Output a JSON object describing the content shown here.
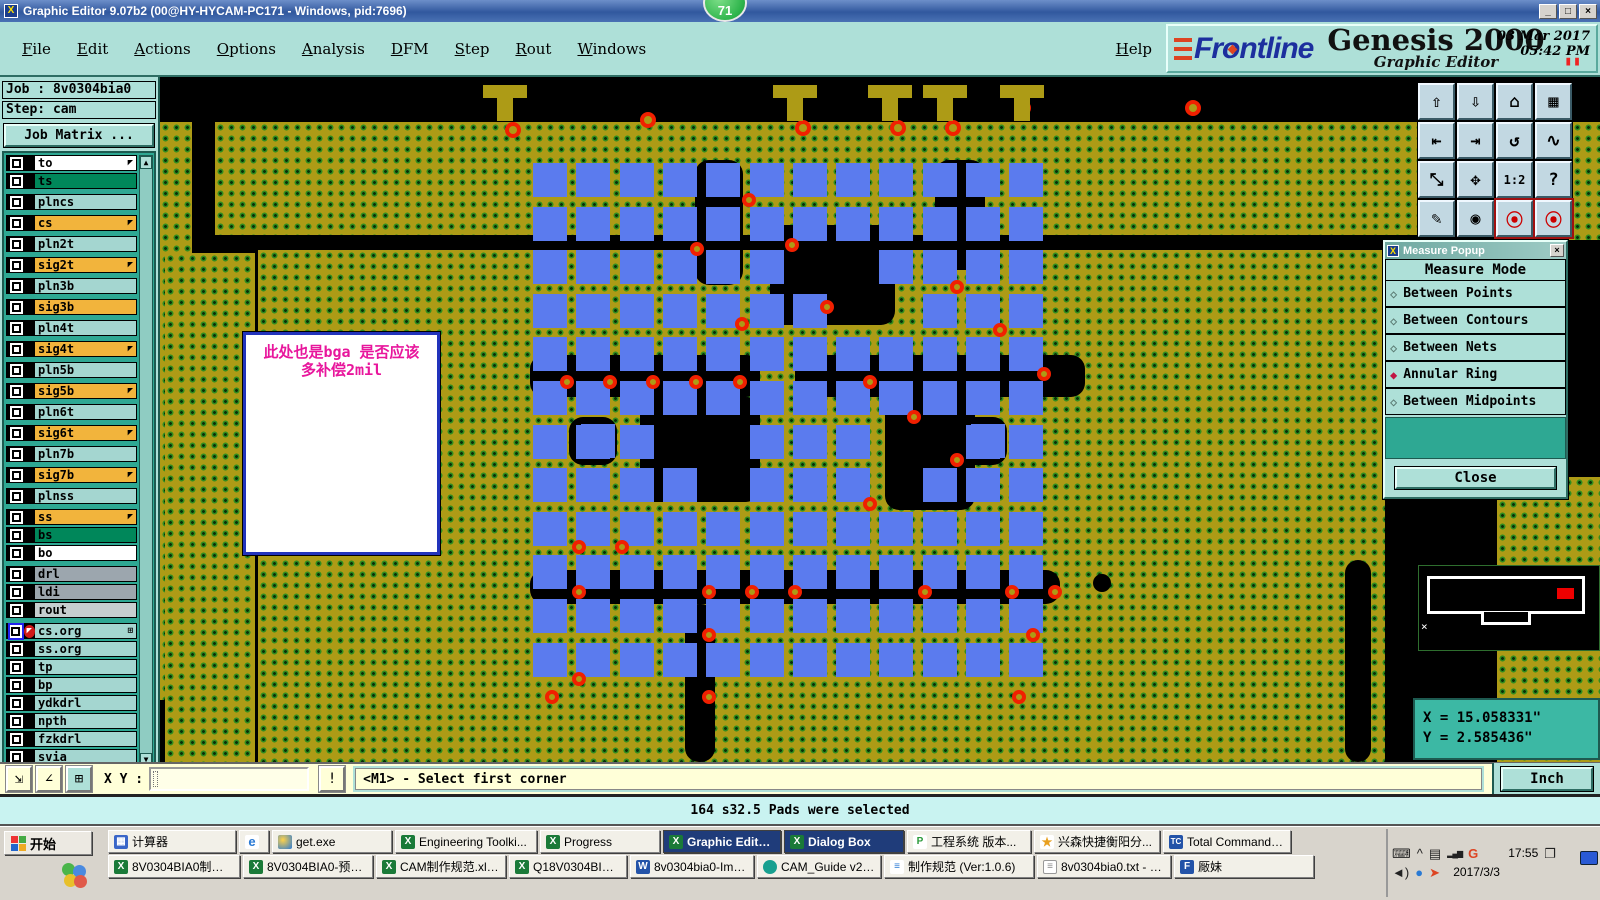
{
  "window": {
    "title": "Graphic Editor 9.07b2 (00@HY-HYCAM-PC171 - Windows, pid:7696)",
    "minimize": "_",
    "maximize": "□",
    "close": "×",
    "badge": "71"
  },
  "menu": {
    "items": [
      "File",
      "Edit",
      "Actions",
      "Options",
      "Analysis",
      "DFM",
      "Step",
      "Rout",
      "Windows"
    ],
    "help": "Help"
  },
  "brand": {
    "logo": "Frontline",
    "product": "Genesis 2000",
    "subtitle": "Graphic Editor",
    "date": "03 Mar 2017",
    "time": "05:42 PM",
    "pause": "▮▮"
  },
  "sidebar": {
    "job_label": "Job : 8v0304bia0",
    "step_label": "Step: cam",
    "job_matrix_button": "Job Matrix ...",
    "selected_label": "Selected : 166",
    "scroll_up": "▲",
    "scroll_down": "▼",
    "layers": [
      {
        "name": "to",
        "color": "white",
        "arrow": true
      },
      {
        "name": "ts",
        "color": "green"
      },
      {
        "name": "plncs",
        "color": "teal",
        "gap": true
      },
      {
        "name": "cs",
        "color": "orange",
        "arrow": true,
        "gap": true
      },
      {
        "name": "pln2t",
        "color": "teal",
        "gap": true
      },
      {
        "name": "sig2t",
        "color": "orange",
        "arrow": true,
        "gap": true
      },
      {
        "name": "pln3b",
        "color": "teal",
        "gap": true
      },
      {
        "name": "sig3b",
        "color": "orange",
        "gap": true
      },
      {
        "name": "pln4t",
        "color": "teal",
        "gap": true
      },
      {
        "name": "sig4t",
        "color": "orange",
        "arrow": true,
        "gap": true
      },
      {
        "name": "pln5b",
        "color": "teal",
        "gap": true
      },
      {
        "name": "sig5b",
        "color": "orange",
        "arrow": true,
        "gap": true
      },
      {
        "name": "pln6t",
        "color": "teal",
        "gap": true
      },
      {
        "name": "sig6t",
        "color": "orange",
        "arrow": true,
        "gap": true
      },
      {
        "name": "pln7b",
        "color": "teal",
        "gap": true
      },
      {
        "name": "sig7b",
        "color": "orange",
        "arrow": true,
        "gap": true
      },
      {
        "name": "plnss",
        "color": "teal",
        "gap": true
      },
      {
        "name": "ss",
        "color": "orange",
        "arrow": true,
        "gap": true
      },
      {
        "name": "bs",
        "color": "green"
      },
      {
        "name": "bo",
        "color": "white"
      },
      {
        "name": "drl",
        "color": "gray",
        "gap": true
      },
      {
        "name": "ldi",
        "color": "gray"
      },
      {
        "name": "rout",
        "color": "lgray"
      },
      {
        "name": "cs.org",
        "color": "teal",
        "gap": true,
        "selected": true,
        "grid": true
      },
      {
        "name": "ss.org",
        "color": "teal"
      },
      {
        "name": "tp",
        "color": "teal"
      },
      {
        "name": "bp",
        "color": "teal"
      },
      {
        "name": "ydkdrl",
        "color": "teal"
      },
      {
        "name": "npth",
        "color": "teal"
      },
      {
        "name": "fzkdrl",
        "color": "teal"
      },
      {
        "name": "svia",
        "color": "teal"
      }
    ]
  },
  "right_toolbar": {
    "buttons": [
      {
        "name": "zoom-in",
        "glyph": "⇧"
      },
      {
        "name": "zoom-out",
        "glyph": "⇩"
      },
      {
        "name": "home-view",
        "glyph": "⌂"
      },
      {
        "name": "zoom-window-xy",
        "glyph": "▦"
      },
      {
        "name": "view-previous",
        "glyph": "⇤"
      },
      {
        "name": "view-next",
        "glyph": "⇥"
      },
      {
        "name": "redraw",
        "glyph": "↺"
      },
      {
        "name": "serpentine",
        "glyph": "∿"
      },
      {
        "name": "fit-expand",
        "glyph": "⤡"
      },
      {
        "name": "pan-center",
        "glyph": "✥"
      },
      {
        "name": "scale-1-2",
        "glyph": "1:2",
        "small": true
      },
      {
        "name": "help",
        "glyph": "?"
      },
      {
        "name": "setup-tools",
        "glyph": "✎"
      },
      {
        "name": "highlight-net",
        "glyph": "◉"
      },
      {
        "name": "display-config-a",
        "glyph": "⦿",
        "red": true
      },
      {
        "name": "display-config-b",
        "glyph": "⦿",
        "red": true
      }
    ]
  },
  "measure_popup": {
    "title": "Measure Popup",
    "header": "Measure Mode",
    "options": [
      {
        "label": "Between Points",
        "selected": false
      },
      {
        "label": "Between Contours",
        "selected": false
      },
      {
        "label": "Between Nets",
        "selected": false
      },
      {
        "label": "Annular Ring",
        "selected": true
      },
      {
        "label": "Between Midpoints",
        "selected": false
      }
    ],
    "close_button": "Close",
    "close_x": "×"
  },
  "coords": {
    "x": "X = 15.058331\"",
    "y": "Y = 2.585436\""
  },
  "statusbar": {
    "xy_label": "X Y :",
    "input_value": "",
    "alert_button": "!",
    "message": "<M1> - Select first corner",
    "units_button": "Inch",
    "tools": [
      {
        "name": "measure-diagonal",
        "glyph": "⇲"
      },
      {
        "name": "measure-angle",
        "glyph": "∠"
      },
      {
        "name": "grid-toggle",
        "glyph": "⊞",
        "teal": true
      }
    ]
  },
  "messagebar": {
    "text": "164 s32.5 Pads were selected"
  },
  "canvas": {
    "colors": {
      "copper": "#ad9b16",
      "pad": "#5b7bee",
      "ring": "#f02000",
      "dot": "#2f8c1f",
      "background": "#000000"
    },
    "annotation": {
      "line1": "此处也是bga  是否应该",
      "line2": "多补偿2mil",
      "x": 83,
      "y": 255,
      "w": 197,
      "h": 223
    },
    "copper": [
      [
        0,
        45,
        32,
        578
      ],
      [
        55,
        45,
        1215,
        113
      ],
      [
        1335,
        45,
        105,
        118
      ],
      [
        5,
        176,
        90,
        509
      ],
      [
        98,
        173,
        1127,
        512
      ],
      [
        1337,
        400,
        103,
        285
      ]
    ],
    "black": [
      [
        535,
        83,
        48,
        125
      ],
      [
        610,
        148,
        125,
        100
      ],
      [
        775,
        83,
        50,
        110
      ],
      [
        370,
        278,
        230,
        42
      ],
      [
        635,
        278,
        290,
        42
      ],
      [
        480,
        320,
        120,
        105
      ],
      [
        725,
        313,
        90,
        120
      ],
      [
        370,
        493,
        530,
        34
      ],
      [
        525,
        527,
        30,
        158
      ],
      [
        1185,
        483,
        26,
        202
      ],
      [
        409,
        340,
        48,
        48
      ],
      [
        799,
        340,
        48,
        48
      ]
    ],
    "bga": {
      "x": 373,
      "y": 86,
      "cols": 12,
      "rows": 12,
      "pitch_x": 43.3,
      "pitch_y": 43.6,
      "size": 34,
      "skips": [
        [
          2,
          6
        ],
        [
          2,
          7
        ],
        [
          3,
          7
        ],
        [
          3,
          8
        ],
        [
          6,
          3
        ],
        [
          6,
          4
        ],
        [
          7,
          4
        ],
        [
          6,
          8
        ],
        [
          7,
          8
        ],
        [
          6,
          9
        ]
      ]
    },
    "pads_over": [
      [
        421,
        347
      ],
      [
        811,
        347
      ]
    ],
    "vias": [
      [
        582,
        116
      ],
      [
        625,
        161
      ],
      [
        530,
        165
      ],
      [
        575,
        240
      ],
      [
        660,
        223
      ],
      [
        400,
        298
      ],
      [
        443,
        298
      ],
      [
        486,
        298
      ],
      [
        529,
        298
      ],
      [
        573,
        298
      ],
      [
        703,
        298
      ],
      [
        790,
        203
      ],
      [
        833,
        246
      ],
      [
        877,
        290
      ],
      [
        747,
        333
      ],
      [
        790,
        376
      ],
      [
        703,
        420
      ],
      [
        412,
        463
      ],
      [
        455,
        463
      ],
      [
        412,
        508
      ],
      [
        542,
        508
      ],
      [
        585,
        508
      ],
      [
        628,
        508
      ],
      [
        758,
        508
      ],
      [
        845,
        508
      ],
      [
        888,
        508
      ],
      [
        542,
        551
      ],
      [
        866,
        551
      ],
      [
        412,
        595
      ],
      [
        542,
        613
      ],
      [
        852,
        613
      ],
      [
        385,
        613
      ]
    ],
    "rings": [
      [
        480,
        35
      ],
      [
        855,
        23
      ],
      [
        1025,
        23
      ],
      [
        1275,
        18
      ],
      [
        345,
        45
      ],
      [
        635,
        43
      ],
      [
        730,
        43
      ],
      [
        785,
        43
      ]
    ],
    "stubs": [
      [
        323,
        8,
        44,
        13
      ],
      [
        337,
        8,
        16,
        36
      ],
      [
        613,
        8,
        44,
        13
      ],
      [
        627,
        8,
        16,
        36
      ],
      [
        708,
        8,
        44,
        13
      ],
      [
        722,
        8,
        16,
        36
      ],
      [
        763,
        8,
        44,
        13
      ],
      [
        777,
        8,
        16,
        36
      ],
      [
        840,
        8,
        44,
        13
      ],
      [
        854,
        8,
        16,
        36
      ]
    ],
    "donut": {
      "x": 933,
      "y": 497
    },
    "minimap": {
      "x_mark": "×"
    }
  },
  "taskbar": {
    "start": "开始",
    "row1": [
      {
        "label": "计算器",
        "icon": "calc",
        "w": 128
      },
      {
        "label": "",
        "icon": "ie",
        "w": 30
      },
      {
        "label": "get.exe",
        "icon": "get",
        "w": 120
      },
      {
        "label": "Engineering Toolki...",
        "icon": "excel",
        "w": 142
      },
      {
        "label": "Progress",
        "icon": "excel",
        "w": 120
      },
      {
        "label": "Graphic Editor 9....",
        "icon": "excel",
        "w": 118,
        "active": true
      },
      {
        "label": "Dialog Box",
        "icon": "excel",
        "w": 120,
        "active": true
      },
      {
        "label": "工程系统  版本...",
        "icon": "p",
        "w": 124
      },
      {
        "label": "兴森快捷衡阳分...",
        "icon": "star",
        "w": 126
      },
      {
        "label": "Total Commander ...",
        "icon": "tc",
        "w": 128
      }
    ],
    "row2": [
      {
        "label": "8V0304BIA0制作单....",
        "icon": "excel",
        "w": 132
      },
      {
        "label": "8V0304BIA0-预审指...",
        "icon": "excel",
        "w": 130
      },
      {
        "label": "CAM制作规范.xls [...",
        "icon": "excel",
        "w": 130
      },
      {
        "label": "Q18V0304BIA0(zxt)...",
        "icon": "excel",
        "w": 118
      },
      {
        "label": "8v0304bia0-Impeda...",
        "icon": "word",
        "w": 124
      },
      {
        "label": "CAM_Guide v2.79",
        "icon": "cam",
        "w": 124
      },
      {
        "label": "制作规范 (Ver:1.0.6)",
        "icon": "doc",
        "w": 150
      },
      {
        "label": "8v0304bia0.txt - 记...",
        "icon": "note",
        "w": 134
      },
      {
        "label": "厰妹",
        "icon": "f",
        "w": 140
      }
    ],
    "tray": {
      "time": "17:55",
      "date": "2017/3/3",
      "icons": [
        {
          "name": "keyboard-icon",
          "glyph": "⌨"
        },
        {
          "name": "expand-icon",
          "glyph": "^"
        },
        {
          "name": "clipboard-icon",
          "glyph": "▤"
        },
        {
          "name": "signal-icon",
          "glyph": "▂▄▆"
        },
        {
          "name": "g-icon",
          "glyph": "G"
        },
        {
          "name": "clock",
          "glyph": ""
        },
        {
          "name": "cascade-icon",
          "glyph": "❐"
        },
        {
          "name": "volume-icon",
          "glyph": "◄)"
        },
        {
          "name": "flash-icon",
          "glyph": "●"
        },
        {
          "name": "arrow-icon",
          "glyph": "➤"
        }
      ]
    }
  }
}
